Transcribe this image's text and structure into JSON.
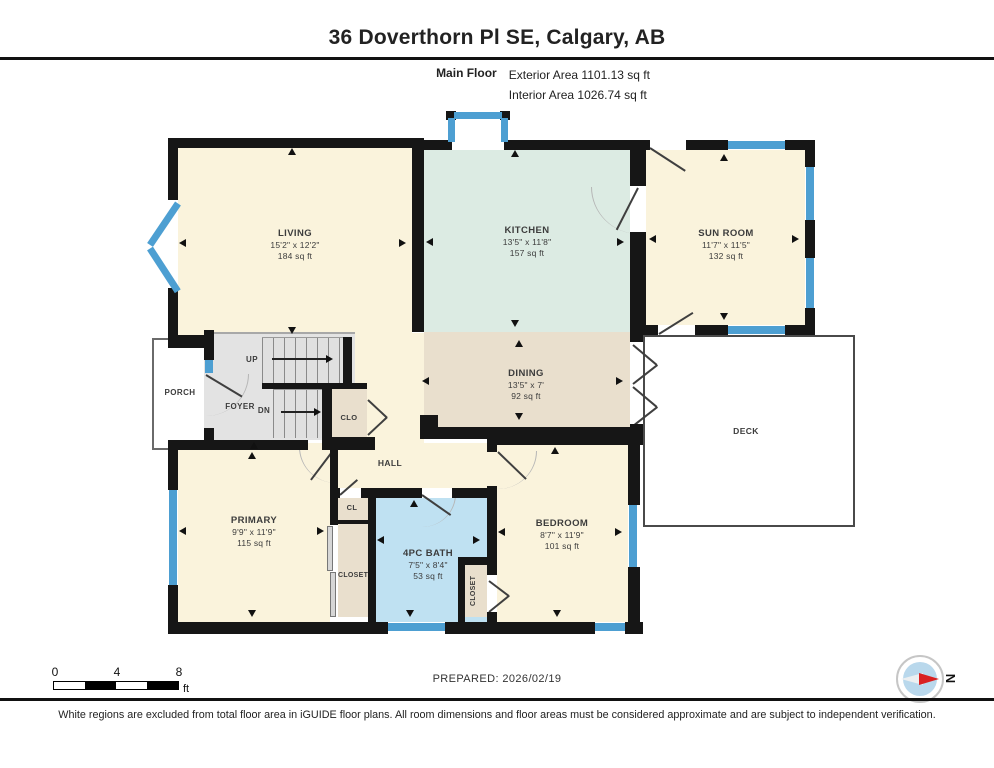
{
  "header": {
    "title": "36 Doverthorn Pl SE, Calgary, AB",
    "floor_label": "Main Floor",
    "exterior_area": "Exterior Area 1101.13 sq ft",
    "interior_area": "Interior Area 1026.74 sq ft"
  },
  "rooms": {
    "living": {
      "name": "LIVING",
      "dims": "15'2\" x 12'2\"",
      "area": "184 sq ft"
    },
    "kitchen": {
      "name": "KITCHEN",
      "dims": "13'5\" x 11'8\"",
      "area": "157 sq ft"
    },
    "sunroom": {
      "name": "SUN ROOM",
      "dims": "11'7\" x 11'5\"",
      "area": "132 sq ft"
    },
    "dining": {
      "name": "DINING",
      "dims": "13'5\" x 7'",
      "area": "92 sq ft"
    },
    "primary": {
      "name": "PRIMARY",
      "dims": "9'9\" x 11'9\"",
      "area": "115 sq ft"
    },
    "bath": {
      "name": "4PC BATH",
      "dims": "7'5\" x 8'4\"",
      "area": "53 sq ft"
    },
    "bedroom": {
      "name": "BEDROOM",
      "dims": "8'7\" x 11'9\"",
      "area": "101 sq ft"
    }
  },
  "labels": {
    "hall": "HALL",
    "foyer": "FOYER",
    "porch": "PORCH",
    "deck": "DECK",
    "clo": "CLO",
    "cl": "CL",
    "closet": "CLOSET",
    "up": "UP",
    "dn": "DN"
  },
  "scale_bar": {
    "ticks": [
      "0",
      "4",
      "8"
    ],
    "unit": "ft"
  },
  "compass": {
    "north_label": "N"
  },
  "footer": {
    "prepared": "PREPARED: 2026/02/19",
    "disclaimer": "White regions are excluded from total floor area in iGUIDE floor plans. All room dimensions and floor areas must be considered approximate and are subject to independent verification."
  },
  "colors": {
    "wall": "#161616",
    "window": "#4d9fd2",
    "room_cream": "#faf3dc",
    "kitchen_green": "#dcebe3",
    "dining_tan": "#e9dfcd",
    "bath_blue": "#bfe1f2",
    "stairs_gray": "#e3e3e3",
    "compass_red": "#d92121"
  }
}
